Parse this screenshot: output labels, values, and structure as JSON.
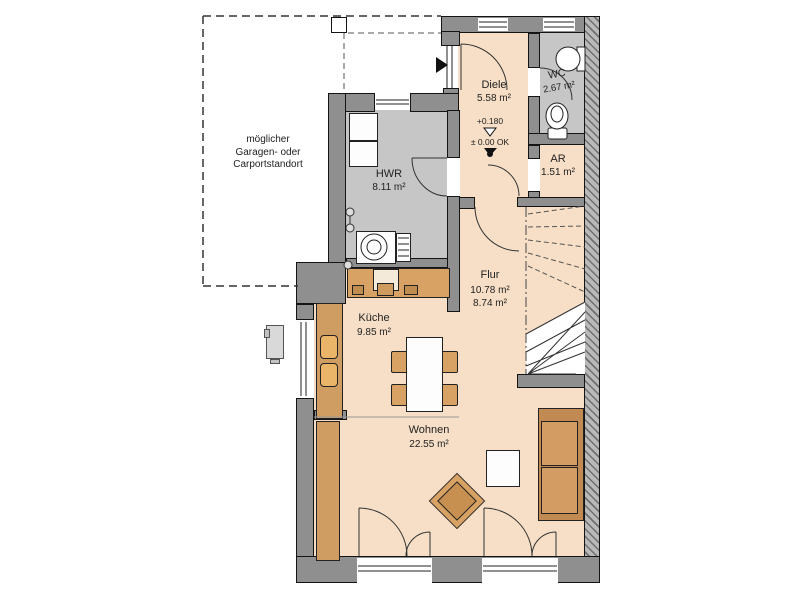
{
  "plan": {
    "garage_note": [
      "möglicher",
      "Garagen- oder",
      "Carportstandort"
    ],
    "rooms": {
      "diele": {
        "name": "Diele",
        "area": "5.58 m²"
      },
      "wc": {
        "name": "WC",
        "area": "2.67 m²"
      },
      "ar": {
        "name": "AR",
        "area": "1.51 m²"
      },
      "hwr": {
        "name": "HWR",
        "area": "8.11 m²"
      },
      "flur": {
        "name": "Flur",
        "area": "10.78 m²",
        "area_secondary": "8.74 m²"
      },
      "kueche": {
        "name": "Küche",
        "area": "9.85 m²"
      },
      "wohnen": {
        "name": "Wohnen",
        "area": "22.55 m²"
      }
    },
    "level_markers": {
      "entry": "+0.180",
      "ground": "± 0.00 OK"
    },
    "colors": {
      "room_floor": "#f6dfc6",
      "utility_floor": "#c6c6c6",
      "wall": "#8f8f8f",
      "furniture": "#d7a263"
    }
  }
}
